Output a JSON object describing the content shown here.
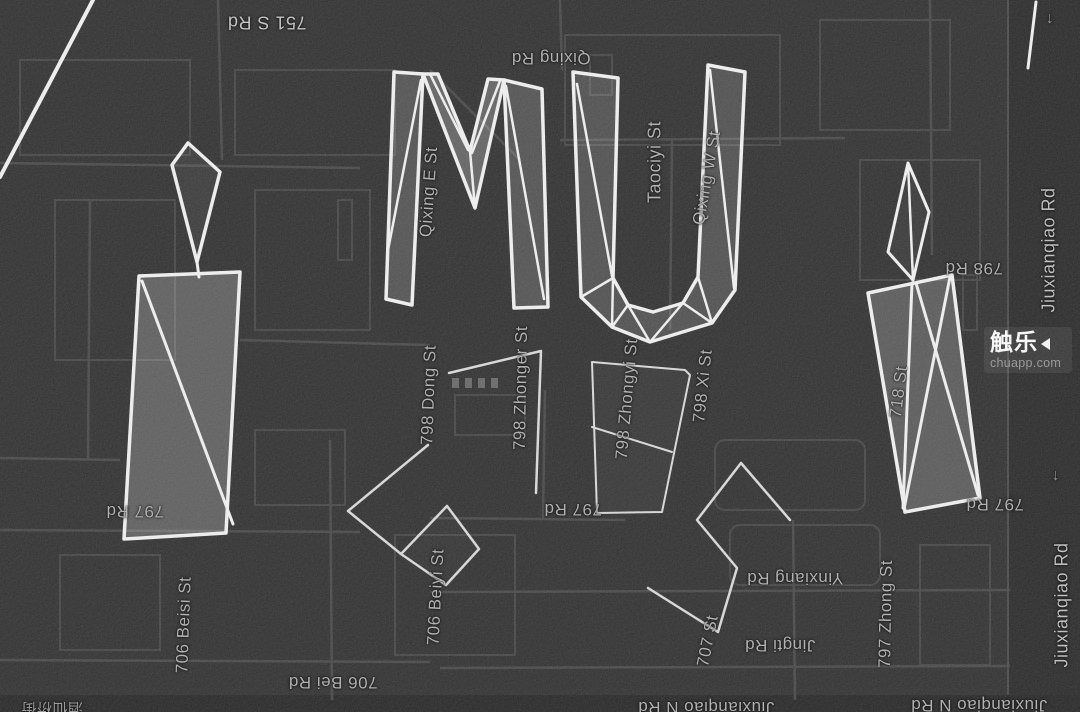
{
  "map": {
    "label_default_color": "#b2b2b2",
    "labels": [
      {
        "name": "road-label-751-s-rd",
        "text": "751 S Rd",
        "x": 267,
        "y": 22,
        "rot": 180,
        "size": 18,
        "color": "#c6c6c6"
      },
      {
        "name": "road-label-qixing-rd",
        "text": "Qixing Rd",
        "x": 551,
        "y": 58,
        "rot": 180,
        "size": 17
      },
      {
        "name": "road-label-qixing-e-st",
        "text": "Qixing E St",
        "x": 429,
        "y": 192,
        "rot": -86,
        "size": 17
      },
      {
        "name": "road-label-taociyi-st",
        "text": "Taociyi St",
        "x": 655,
        "y": 162,
        "rot": -90,
        "size": 18
      },
      {
        "name": "road-label-qixing-w-st",
        "text": "Qixing W St",
        "x": 707,
        "y": 178,
        "rot": -80,
        "size": 17
      },
      {
        "name": "road-label-jiuxianqiao-rd-top",
        "text": "Jiuxianqiao Rd",
        "x": 1049,
        "y": 250,
        "rot": -90,
        "size": 18,
        "color": "#c0c0c0"
      },
      {
        "name": "road-label-798-rd",
        "text": "798 Rd",
        "x": 974,
        "y": 268,
        "rot": 180,
        "size": 17
      },
      {
        "name": "road-label-718-st",
        "text": "718 St",
        "x": 899,
        "y": 392,
        "rot": -83,
        "size": 17
      },
      {
        "name": "road-label-798-dong-st",
        "text": "798 Dong St",
        "x": 429,
        "y": 395,
        "rot": -88,
        "size": 17
      },
      {
        "name": "road-label-798-zhonger-st",
        "text": "798 Zhonger St",
        "x": 521,
        "y": 388,
        "rot": -89,
        "size": 17
      },
      {
        "name": "road-label-798-zhongyi-st",
        "text": "798 Zhongyi St",
        "x": 627,
        "y": 399,
        "rot": -85,
        "size": 17
      },
      {
        "name": "road-label-798-xi-st",
        "text": "798 Xi St",
        "x": 703,
        "y": 386,
        "rot": -84,
        "size": 17
      },
      {
        "name": "road-label-797-rd-left",
        "text": "797 Rd",
        "x": 135,
        "y": 511,
        "rot": 180,
        "size": 17
      },
      {
        "name": "road-label-706-beisi-st",
        "text": "706 Beisi St",
        "x": 184,
        "y": 625,
        "rot": -88,
        "size": 17
      },
      {
        "name": "road-label-706-beiyi-st",
        "text": "706 Beiyi St",
        "x": 436,
        "y": 597,
        "rot": -87,
        "size": 17
      },
      {
        "name": "road-label-797-rd-mid",
        "text": "797 Rd",
        "x": 573,
        "y": 509,
        "rot": 180,
        "size": 17
      },
      {
        "name": "road-label-yinxiang-rd",
        "text": "Yinxiang Rd",
        "x": 795,
        "y": 578,
        "rot": 180,
        "size": 17
      },
      {
        "name": "road-label-jingti-rd",
        "text": "Jingti Rd",
        "x": 780,
        "y": 645,
        "rot": 180,
        "size": 17
      },
      {
        "name": "road-label-707-st",
        "text": "707 St",
        "x": 708,
        "y": 641,
        "rot": -79,
        "size": 17
      },
      {
        "name": "road-label-797-zhong-st",
        "text": "797 Zhong St",
        "x": 886,
        "y": 614,
        "rot": -89,
        "size": 17
      },
      {
        "name": "road-label-797-rd-right",
        "text": "797 Rd",
        "x": 995,
        "y": 504,
        "rot": 180,
        "size": 17
      },
      {
        "name": "road-label-jiuxianqiao-rd-bottom",
        "text": "Jiuxianqiao Rd",
        "x": 1062,
        "y": 605,
        "rot": -90,
        "size": 18,
        "color": "#c0c0c0"
      },
      {
        "name": "road-label-706-bei-rd",
        "text": "706 Bei Rd",
        "x": 333,
        "y": 682,
        "rot": 180,
        "size": 17
      },
      {
        "name": "road-label-jiuxianqiao-n-rd-center",
        "text": "Jiuxianqiao N Rd",
        "x": 706,
        "y": 707,
        "rot": 180,
        "size": 17
      },
      {
        "name": "road-label-jiuxianqiao-n-rd-right",
        "text": "Jiuxianqiao N Rd",
        "x": 979,
        "y": 705,
        "rot": 180,
        "size": 17
      },
      {
        "name": "road-label-partial-cjk",
        "text": "酒仙桥街",
        "x": 52,
        "y": 709,
        "rot": 180,
        "size": 15,
        "color": "#9a9a9a"
      },
      {
        "name": "one-way-arrow-icon-top",
        "text": "↓",
        "x": 1050,
        "y": 19,
        "rot": 0,
        "size": 16,
        "color": "#9a9a9a"
      },
      {
        "name": "one-way-arrow-icon-mid",
        "text": "↓",
        "x": 1056,
        "y": 476,
        "rot": 0,
        "size": 16,
        "color": "#9a9a9a"
      }
    ]
  },
  "watermark": {
    "logo": "触乐",
    "url": "chuapp.com"
  },
  "overlay": {
    "stroke_color": "#ededed",
    "shapes": [
      {
        "name": "art-line-top-left",
        "type": "polyline",
        "points": "93,0 0,177",
        "stroke_width": 4
      },
      {
        "name": "art-line-top-right",
        "type": "polyline",
        "points": "1036,2 1028,68",
        "stroke_width": 3
      },
      {
        "name": "art-figure-left-head",
        "type": "polygon",
        "points": "188,143 220,172 197,262 172,165",
        "fill_opacity": 0.05,
        "stroke_width": 3.5
      },
      {
        "name": "art-figure-left-neck",
        "type": "polyline",
        "points": "197,262 199,277",
        "stroke_width": 3
      },
      {
        "name": "art-figure-left-body",
        "type": "polygon",
        "points": "139,276 240,272 226,533 124,539",
        "fill_opacity": 0.22,
        "stroke_width": 3.5
      },
      {
        "name": "art-figure-left-facet",
        "type": "polyline",
        "points": "142,281 233,524",
        "stroke_width": 3
      },
      {
        "name": "art-letter-m-left-leg",
        "type": "polygon",
        "points": "394,72 423,74 412,305 386,299",
        "fill_opacity": 0.16,
        "stroke_width": 3.5
      },
      {
        "name": "art-letter-m-right-leg",
        "type": "polygon",
        "points": "504,80 542,89 548,307 514,308",
        "fill_opacity": 0.16,
        "stroke_width": 3.5
      },
      {
        "name": "art-letter-m-v",
        "type": "polygon",
        "points": "423,74 475,208 504,80 488,79 470,151 438,74",
        "fill_opacity": 0.24,
        "stroke_width": 3.5
      },
      {
        "name": "art-letter-m-facet-1",
        "type": "polyline",
        "points": "430,74 468,150",
        "stroke_width": 2.5
      },
      {
        "name": "art-letter-m-facet-2",
        "type": "polyline",
        "points": "500,81 472,153",
        "stroke_width": 2.5
      },
      {
        "name": "art-letter-m-facet-3",
        "type": "polyline",
        "points": "470,151 475,208",
        "stroke_width": 2.5
      },
      {
        "name": "art-letter-m-facet-4",
        "type": "polyline",
        "points": "421,80 388,250",
        "stroke_width": 2.5
      },
      {
        "name": "art-letter-m-facet-5",
        "type": "polyline",
        "points": "506,86 544,299",
        "stroke_width": 2.5
      },
      {
        "name": "art-letter-u",
        "type": "polygon",
        "points": "573,72 618,78 613,278 628,305 653,312 683,303 698,277 708,65 745,72 735,290 712,323 650,342 612,327 581,297",
        "fill_opacity": 0.15,
        "stroke_width": 3.5
      },
      {
        "name": "art-letter-u-facet-1",
        "type": "polyline",
        "points": "577,84 612,276",
        "stroke_width": 2.5
      },
      {
        "name": "art-letter-u-facet-2",
        "type": "polyline",
        "points": "710,70 734,288",
        "stroke_width": 2.5
      },
      {
        "name": "art-letter-u-facet-3",
        "type": "polyline",
        "points": "581,297 613,278",
        "stroke_width": 2.5
      },
      {
        "name": "art-letter-u-facet-4",
        "type": "polyline",
        "points": "612,327 613,278",
        "stroke_width": 2.5
      },
      {
        "name": "art-letter-u-facet-5",
        "type": "polyline",
        "points": "612,327 628,305",
        "stroke_width": 2.5
      },
      {
        "name": "art-letter-u-facet-6",
        "type": "polyline",
        "points": "650,342 628,305",
        "stroke_width": 2.5
      },
      {
        "name": "art-letter-u-facet-7",
        "type": "polyline",
        "points": "650,342 683,303",
        "stroke_width": 2.5
      },
      {
        "name": "art-letter-u-facet-8",
        "type": "polyline",
        "points": "712,323 698,277",
        "stroke_width": 2.5
      },
      {
        "name": "art-letter-u-facet-9",
        "type": "polyline",
        "points": "712,323 683,303",
        "stroke_width": 2.5
      },
      {
        "name": "art-figure-right-head",
        "type": "polygon",
        "points": "908,163 929,212 913,280 888,252",
        "fill_opacity": 0.04,
        "stroke_width": 3
      },
      {
        "name": "art-figure-right-head-facet",
        "type": "polyline",
        "points": "908,163 913,280",
        "stroke_width": 2.5
      },
      {
        "name": "art-figure-right-body",
        "type": "polygon",
        "points": "868,293 952,275 980,498 905,512",
        "fill_opacity": 0.2,
        "stroke_width": 3.5
      },
      {
        "name": "art-figure-right-facet-1",
        "type": "polyline",
        "points": "912,283 903,508",
        "stroke_width": 3
      },
      {
        "name": "art-figure-right-facet-2",
        "type": "polyline",
        "points": "950,277 904,509",
        "stroke_width": 3
      },
      {
        "name": "art-figure-right-facet-3",
        "type": "polyline",
        "points": "916,283 978,495",
        "stroke_width": 3
      },
      {
        "name": "art-quad-center",
        "type": "polygon",
        "points": "592,362 685,370 690,375 662,512 597,513",
        "fill_opacity": 0.03,
        "stroke": "#d8d8d8",
        "stroke_width": 2
      },
      {
        "name": "art-quad-center-facet",
        "type": "polyline",
        "points": "592,427 672,452",
        "stroke": "#d8d8d8",
        "stroke_width": 2
      },
      {
        "name": "art-digit-one",
        "type": "polyline",
        "points": "449,373 541,351 536,493",
        "stroke": "#d8d8d8",
        "stroke_width": 2.5
      },
      {
        "name": "art-zigzag-left",
        "type": "polyline",
        "points": "428,445 348,511 401,554",
        "stroke": "#d8d8d8",
        "stroke_width": 2.5
      },
      {
        "name": "art-diamond-left",
        "type": "polygon",
        "points": "401,554 447,506 479,549 446,585",
        "fill_opacity": 0.02,
        "stroke": "#d8d8d8",
        "stroke_width": 2.5
      },
      {
        "name": "art-zigzag-right",
        "type": "polyline",
        "points": "790,520 741,463 697,520 737,568 718,632 648,588",
        "stroke": "#d8d8d8",
        "stroke_width": 2.5
      }
    ]
  }
}
